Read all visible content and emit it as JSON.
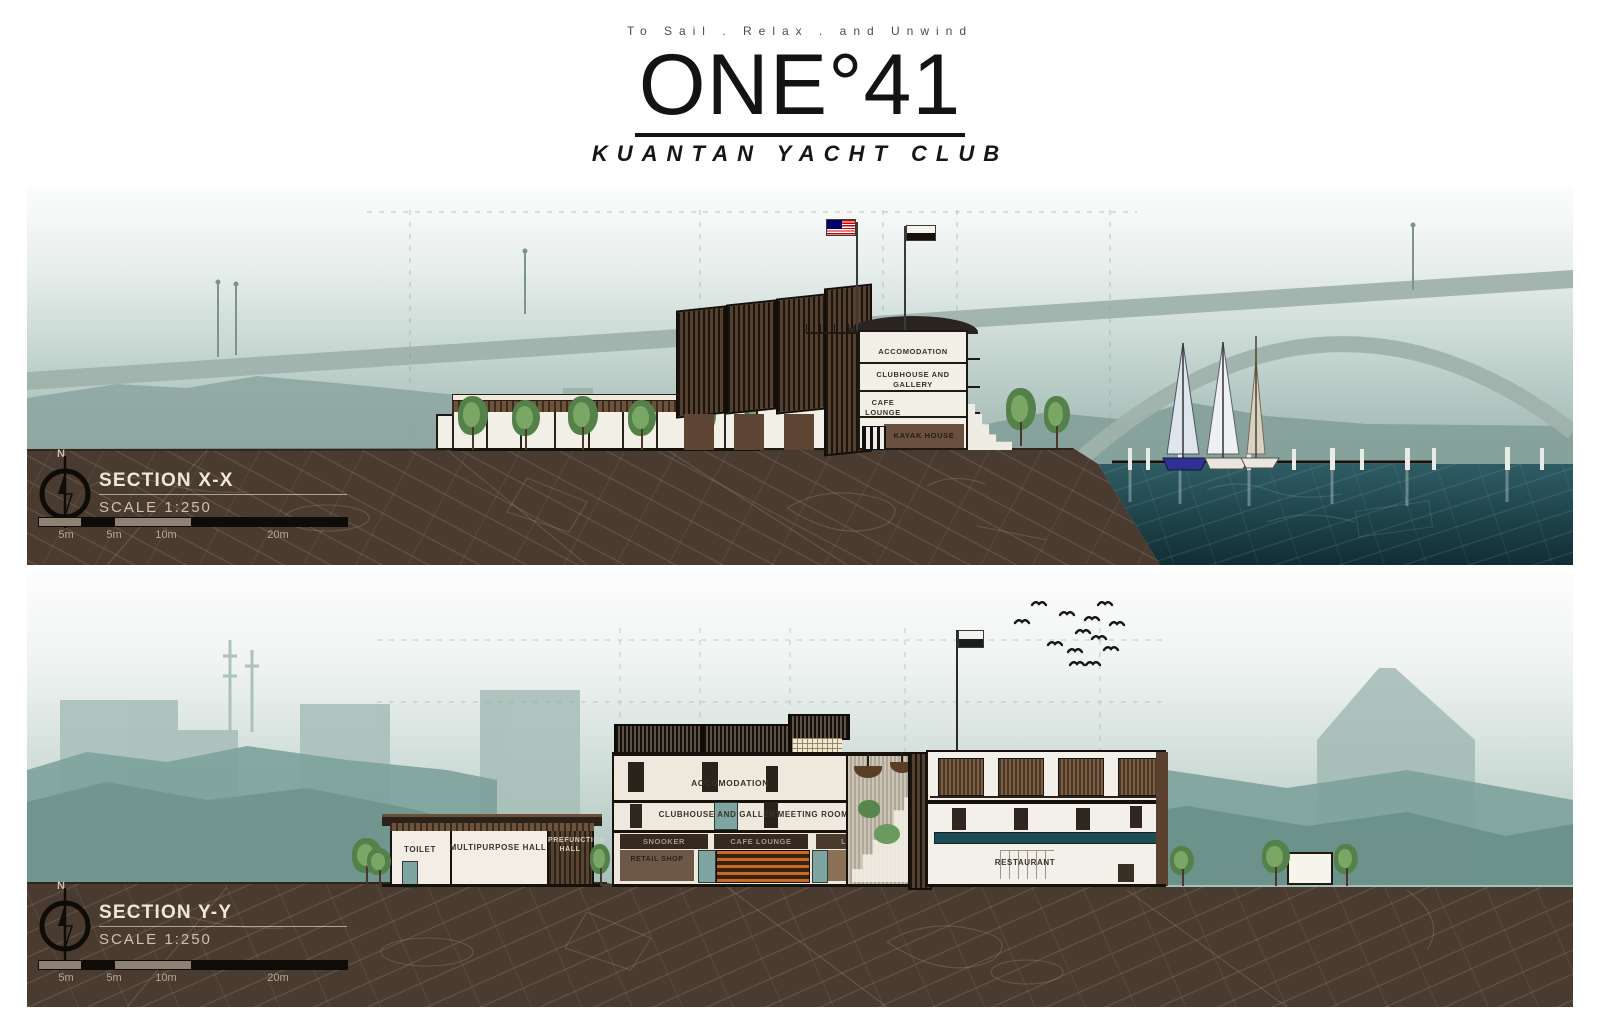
{
  "header": {
    "tagline": "To Sail . Relax . and Unwind",
    "title": "ONE°41",
    "subtitle": "KUANTAN YACHT CLUB"
  },
  "section_xx": {
    "title": "SECTION X-X",
    "scale": "SCALE 1:250",
    "north": "N",
    "scalebar_labels": [
      "5m",
      "5m",
      "10m",
      "20m"
    ],
    "rooms": {
      "accomodation": "ACCOMODATION",
      "clubhouse_gallery": "CLUBHOUSE AND GALLERY",
      "cafe_lounge": "CAFE LOUNGE",
      "kayak_house": "KAYAK HOUSE"
    }
  },
  "section_yy": {
    "title": "SECTION Y-Y",
    "scale": "SCALE 1:250",
    "north": "N",
    "scalebar_labels": [
      "5m",
      "5m",
      "10m",
      "20m"
    ],
    "rooms": {
      "toilet": "TOILET",
      "multipurpose_hall": "MULTIPURPOSE HALL",
      "prefunction_hall": "PREFUNCTION HALL",
      "accomodation": "ACCOMODATION",
      "clubhouse_gallery": "CLUBHOUSE AND GALLERY",
      "meeting_room": "MEETING ROOM",
      "snooker": "SNOOKER",
      "cafe_lounge": "CAFE LOUNGE",
      "lounge": "LOUNGE",
      "retail_shop": "RETAIL SHOP",
      "restaurant": "RESTAURANT"
    }
  },
  "colors": {
    "ground_brown": "#4a3b31",
    "water_teal": "#1d4750",
    "sky_teal": "#93afaa",
    "timber_dark": "#4f3a2b",
    "pool_teal": "#1e4c55",
    "kayak_rack_orange": "#cf6a23",
    "malaysia_flag_red": "#cc0001",
    "malaysia_flag_blue": "#010066"
  }
}
